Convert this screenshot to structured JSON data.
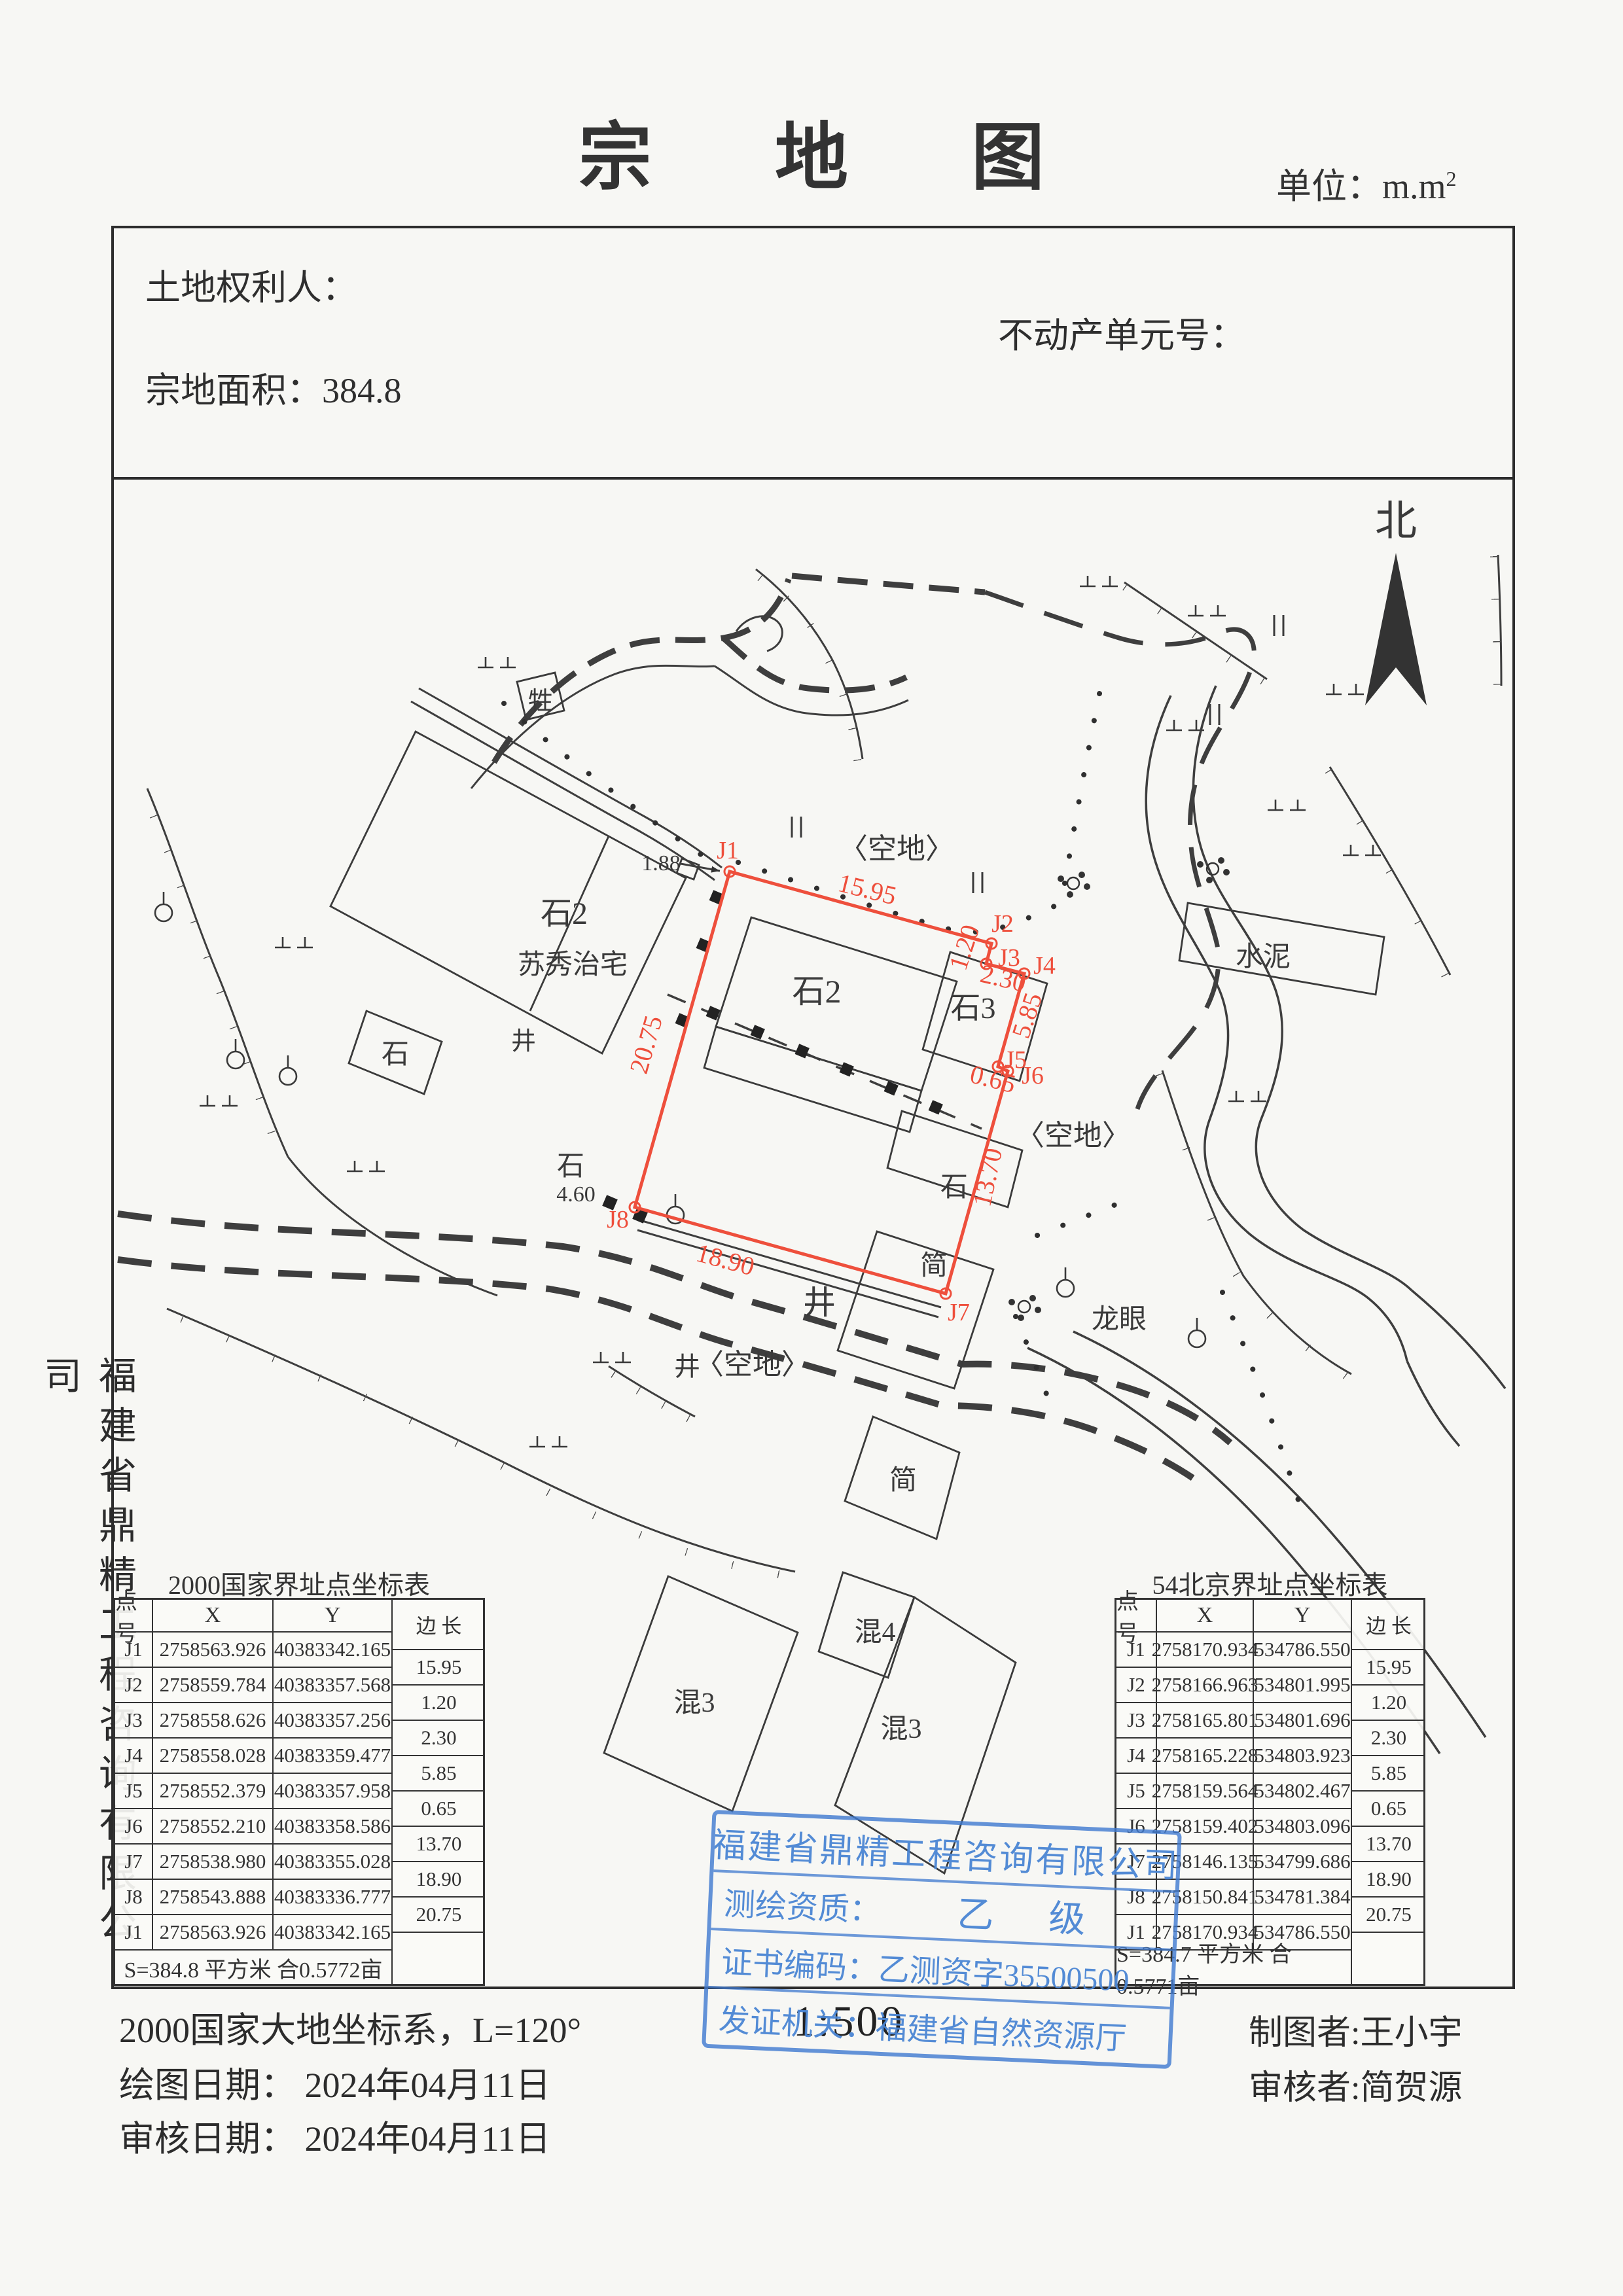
{
  "doc": {
    "title": "宗 地 图",
    "unit_prefix": "单位：m.m",
    "unit_sup": "2"
  },
  "header": {
    "owner": "土地权利人：",
    "unit_no": "不动产单元号：",
    "area": "宗地面积：384.8"
  },
  "map": {
    "north": "北",
    "labels": {
      "kongdi_top": "〈空地〉",
      "kongdi_right": "〈空地〉",
      "kongdi_bottom": "〈空地〉",
      "house_type": "石2",
      "house_name": "苏秀治宅",
      "parcel_bldg": "石2",
      "shi3": "石3",
      "shi_a": "石",
      "shi_b": "石",
      "shi_c": "石",
      "jing_a": "井",
      "jing_b": "井",
      "jing_c": "井",
      "jian_a": "简",
      "jian_b": "简",
      "sheng": "牲",
      "shuini": "水泥",
      "longyan": "龙眼",
      "hun3_a": "混3",
      "hun4": "混4",
      "hun3_b": "混3",
      "dim_a": "1.88",
      "dim_b": "4.60"
    },
    "points": [
      "J1",
      "J2",
      "J3",
      "J4",
      "J5",
      "J6",
      "J7",
      "J8"
    ],
    "edges": [
      "15.95",
      "1.20",
      "2.30",
      "5.85",
      "0.65",
      "13.70",
      "18.90",
      "20.75"
    ]
  },
  "tables": {
    "left": {
      "title": "2000国家界址点坐标表",
      "h_point": "点  号",
      "h_x": "X",
      "h_y": "Y",
      "h_len": "边  长",
      "rows": [
        [
          "J1",
          "2758563.926",
          "40383342.165"
        ],
        [
          "J2",
          "2758559.784",
          "40383357.568"
        ],
        [
          "J3",
          "2758558.626",
          "40383357.256"
        ],
        [
          "J4",
          "2758558.028",
          "40383359.477"
        ],
        [
          "J5",
          "2758552.379",
          "40383357.958"
        ],
        [
          "J6",
          "2758552.210",
          "40383358.586"
        ],
        [
          "J7",
          "2758538.980",
          "40383355.028"
        ],
        [
          "J8",
          "2758543.888",
          "40383336.777"
        ],
        [
          "J1",
          "2758563.926",
          "40383342.165"
        ]
      ],
      "lengths": [
        "15.95",
        "1.20",
        "2.30",
        "5.85",
        "0.65",
        "13.70",
        "18.90",
        "20.75"
      ],
      "summary": "S=384.8 平方米  合0.5772亩"
    },
    "right": {
      "title": "54北京界址点坐标表",
      "h_point": "点  号",
      "h_x": "X",
      "h_y": "Y",
      "h_len": "边  长",
      "rows": [
        [
          "J1",
          "2758170.934",
          "534786.550"
        ],
        [
          "J2",
          "2758166.963",
          "534801.995"
        ],
        [
          "J3",
          "2758165.801",
          "534801.696"
        ],
        [
          "J4",
          "2758165.228",
          "534803.923"
        ],
        [
          "J5",
          "2758159.564",
          "534802.467"
        ],
        [
          "J6",
          "2758159.402",
          "534803.096"
        ],
        [
          "J7",
          "2758146.135",
          "534799.686"
        ],
        [
          "J8",
          "2758150.841",
          "534781.384"
        ],
        [
          "J1",
          "2758170.934",
          "534786.550"
        ]
      ],
      "lengths": [
        "15.95",
        "1.20",
        "2.30",
        "5.85",
        "0.65",
        "13.70",
        "18.90",
        "20.75"
      ],
      "summary": "S=384.7 平方米  合0.5771亩"
    }
  },
  "stamp": {
    "company": "福建省鼎精工程咨询有限公司",
    "quali_label": "测绘资质：",
    "quali_value": "乙      级",
    "cert": "证书编码：乙测资字35500500",
    "issuer": "发证机关：福建省自然资源厅"
  },
  "scale": "1:500",
  "footer": {
    "crs": "2000国家大地坐标系，L=120°",
    "draw_date": "绘图日期： 2024年04月11日",
    "review_date": "审核日期： 2024年04月11日",
    "drafter": "制图者:王小宇",
    "reviewer": "审核者:简贺源"
  },
  "side_company": "福建省鼎精工程咨询有限公司"
}
